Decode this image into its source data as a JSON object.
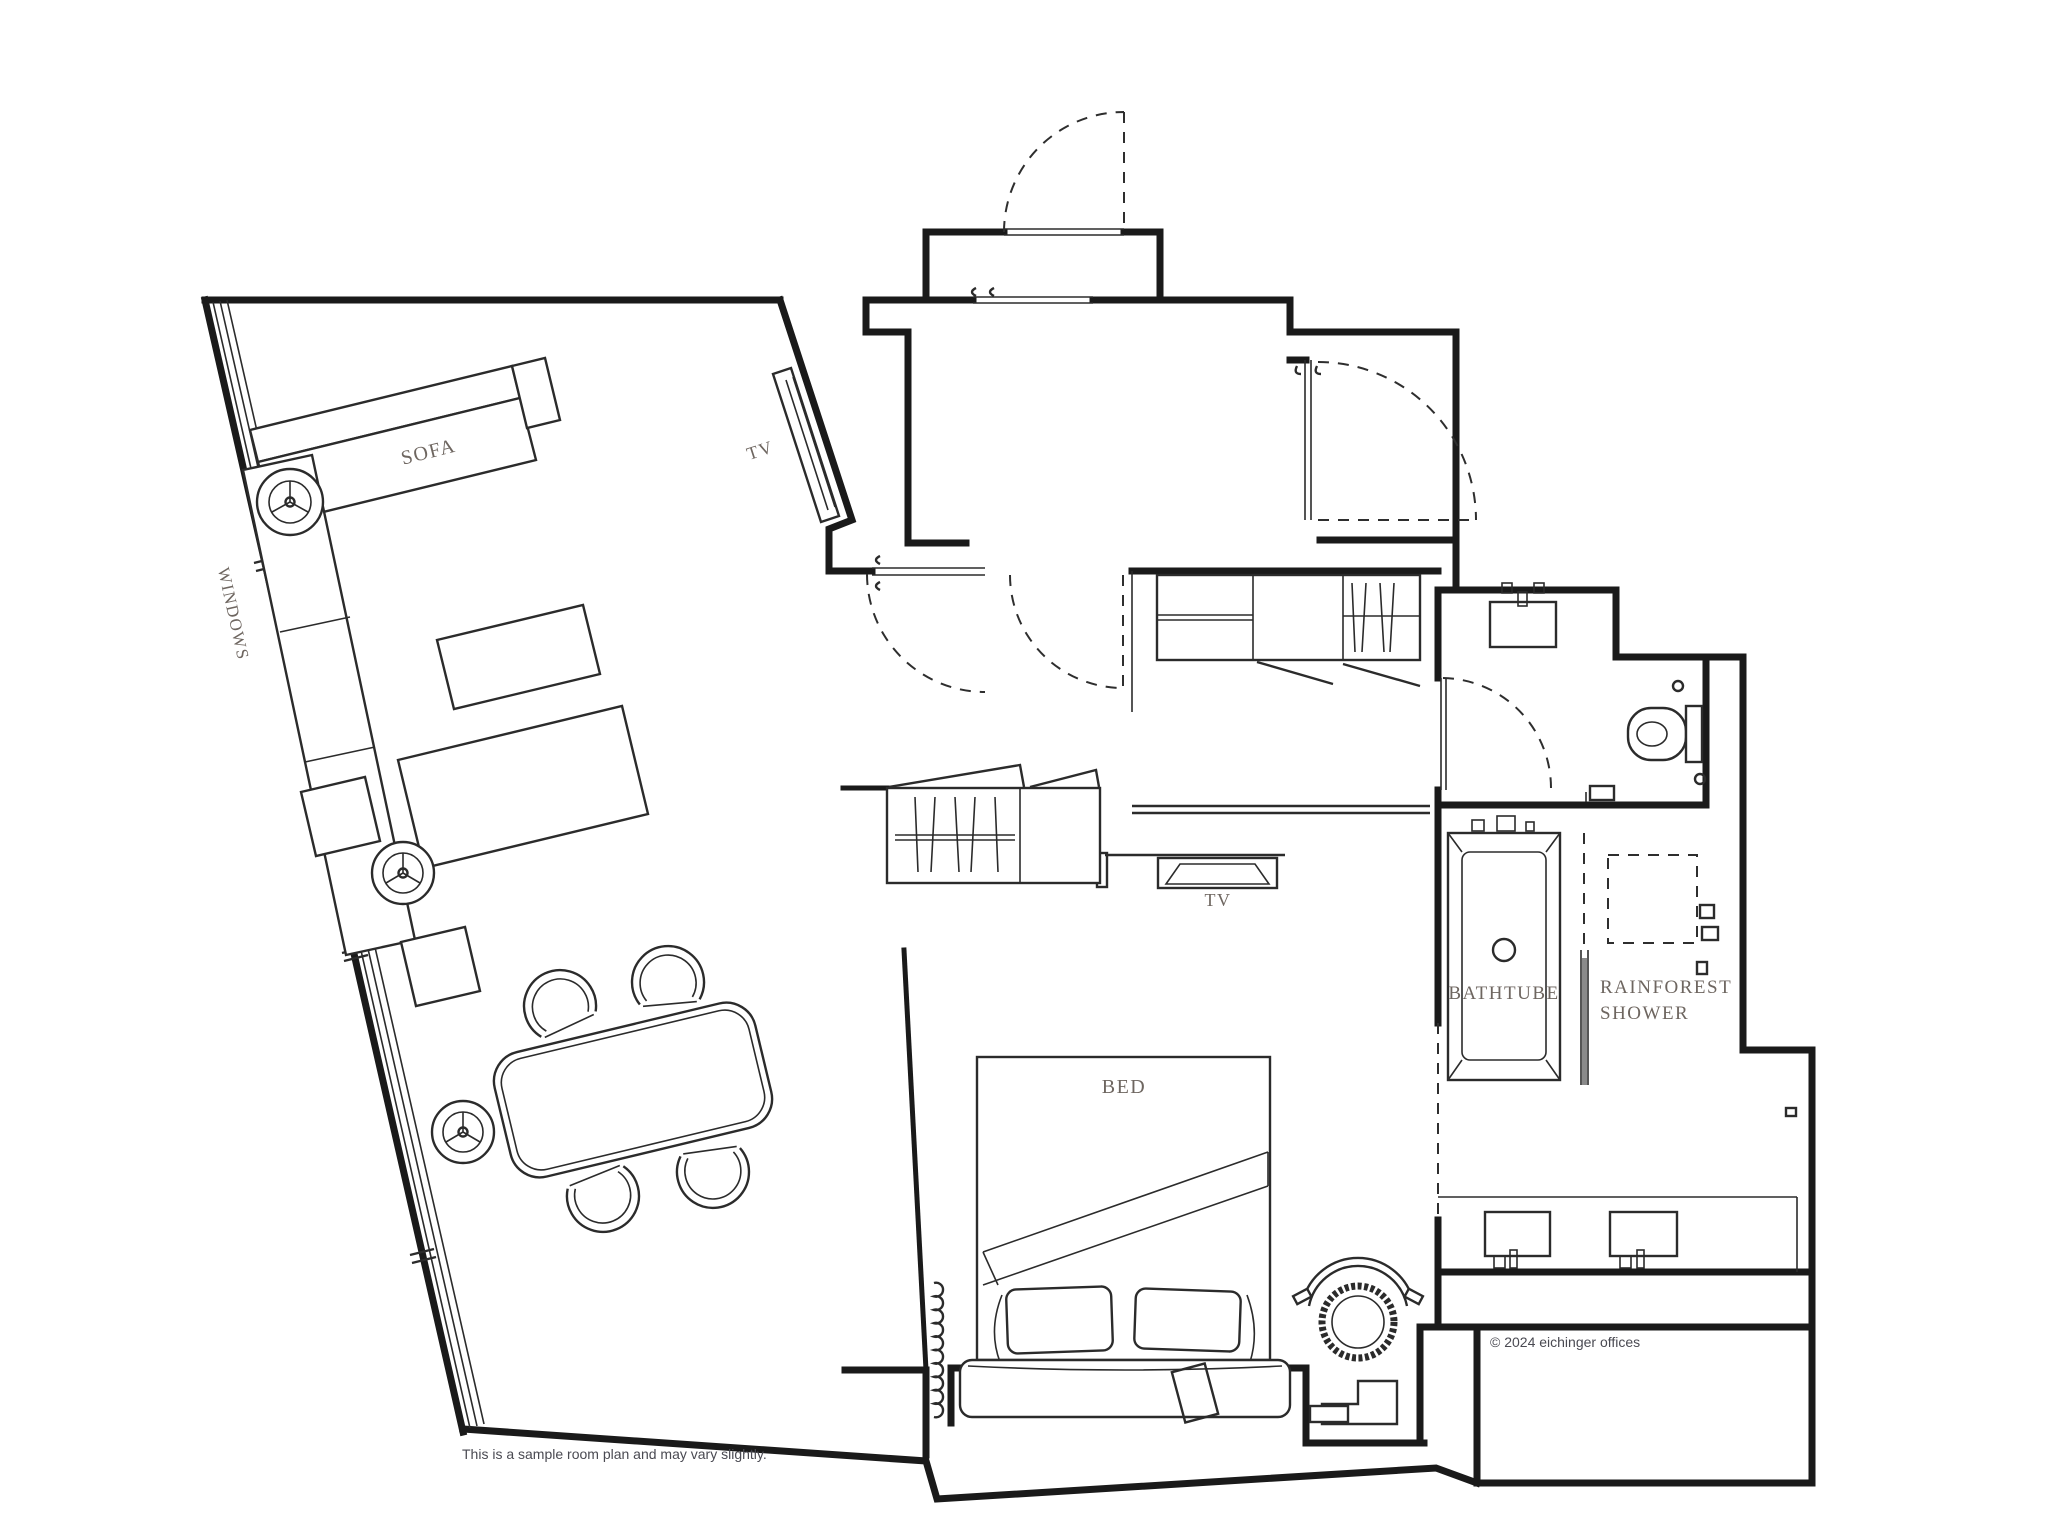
{
  "plan": {
    "labels": {
      "sofa": "SOFA",
      "tv_living": "TV",
      "tv_bedroom": "TV",
      "windows": "WINDOWS",
      "bed": "BED",
      "bathtub": "BATHTUBE",
      "shower_line1": "RAINFOREST",
      "shower_line2": "SHOWER"
    },
    "notes": {
      "disclaimer": "This is a sample room plan and may vary slightly.",
      "copyright": "© 2024 eichinger offices"
    },
    "colors": {
      "wall": "#1a1a1a",
      "furniture": "#2b2b2b",
      "label": "#6e6660",
      "note": "#4a4a52",
      "background": "#ffffff"
    }
  }
}
